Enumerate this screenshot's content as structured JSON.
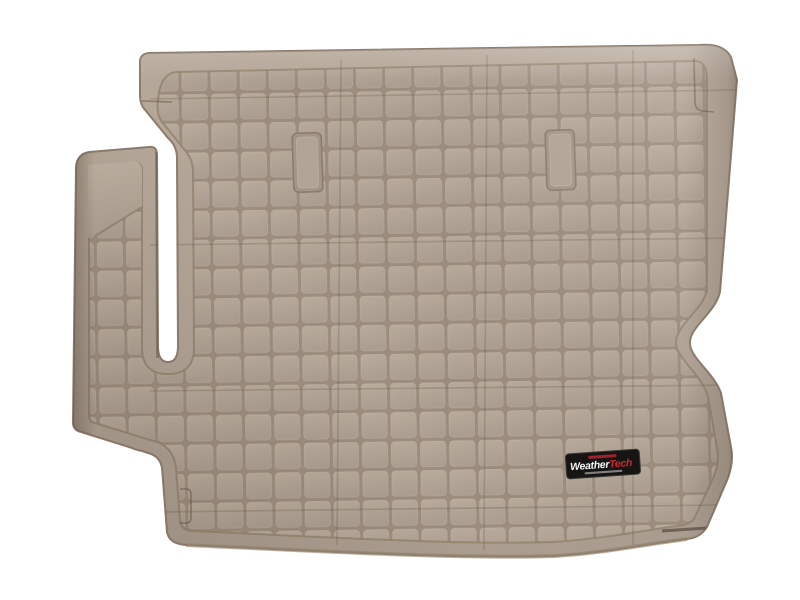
{
  "background_color": "#ffffff",
  "product_photo": {
    "alt": "Tan molded cargo trunk liner with raised grid tread pattern, photographed top-down on white",
    "colors": {
      "mat_base": "#b1a395",
      "mat_light": "#bdafa0",
      "mat_dark": "#a1937f",
      "groove": "#9c8d7e",
      "edge": "#8b7c6d",
      "side_shadow": "#6f6155"
    },
    "badge": {
      "bg_color": "#161514",
      "border_color": "#3c3a38",
      "brand_first": "Weather",
      "brand_second": "Tech",
      "brand_first_color": "#f5f5f5",
      "brand_second_color": "#d42230",
      "top_strip_color": "#a8232e",
      "bottom_strip_color": "#9a9a9a"
    }
  }
}
